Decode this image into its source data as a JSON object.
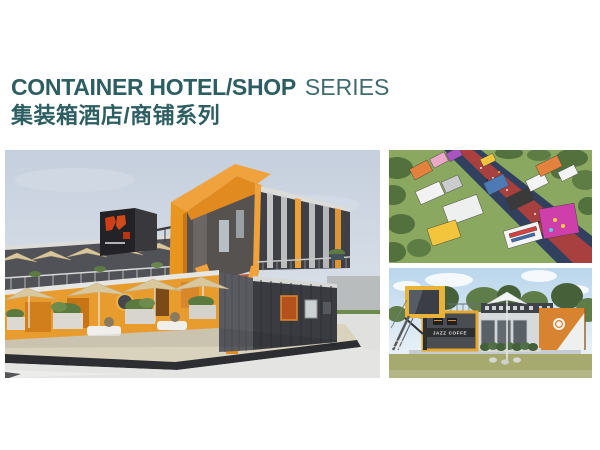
{
  "header": {
    "title_en": "CONTAINER HOTEL/SHOP",
    "title_suffix": "SERIES",
    "title_zh": "集装箱酒店/商铺系列"
  },
  "palette": {
    "teal": "#2d5e62",
    "teal-light": "#3f6b6e",
    "orange": "#f0a23c",
    "orange-deep": "#e08a1f",
    "container-dark": "#3e4045",
    "sky": "#c6d0de",
    "page-bg": "#ffffff"
  },
  "gallery": {
    "bottom_right": {
      "sign_text": "JAZZ COFFE"
    }
  }
}
